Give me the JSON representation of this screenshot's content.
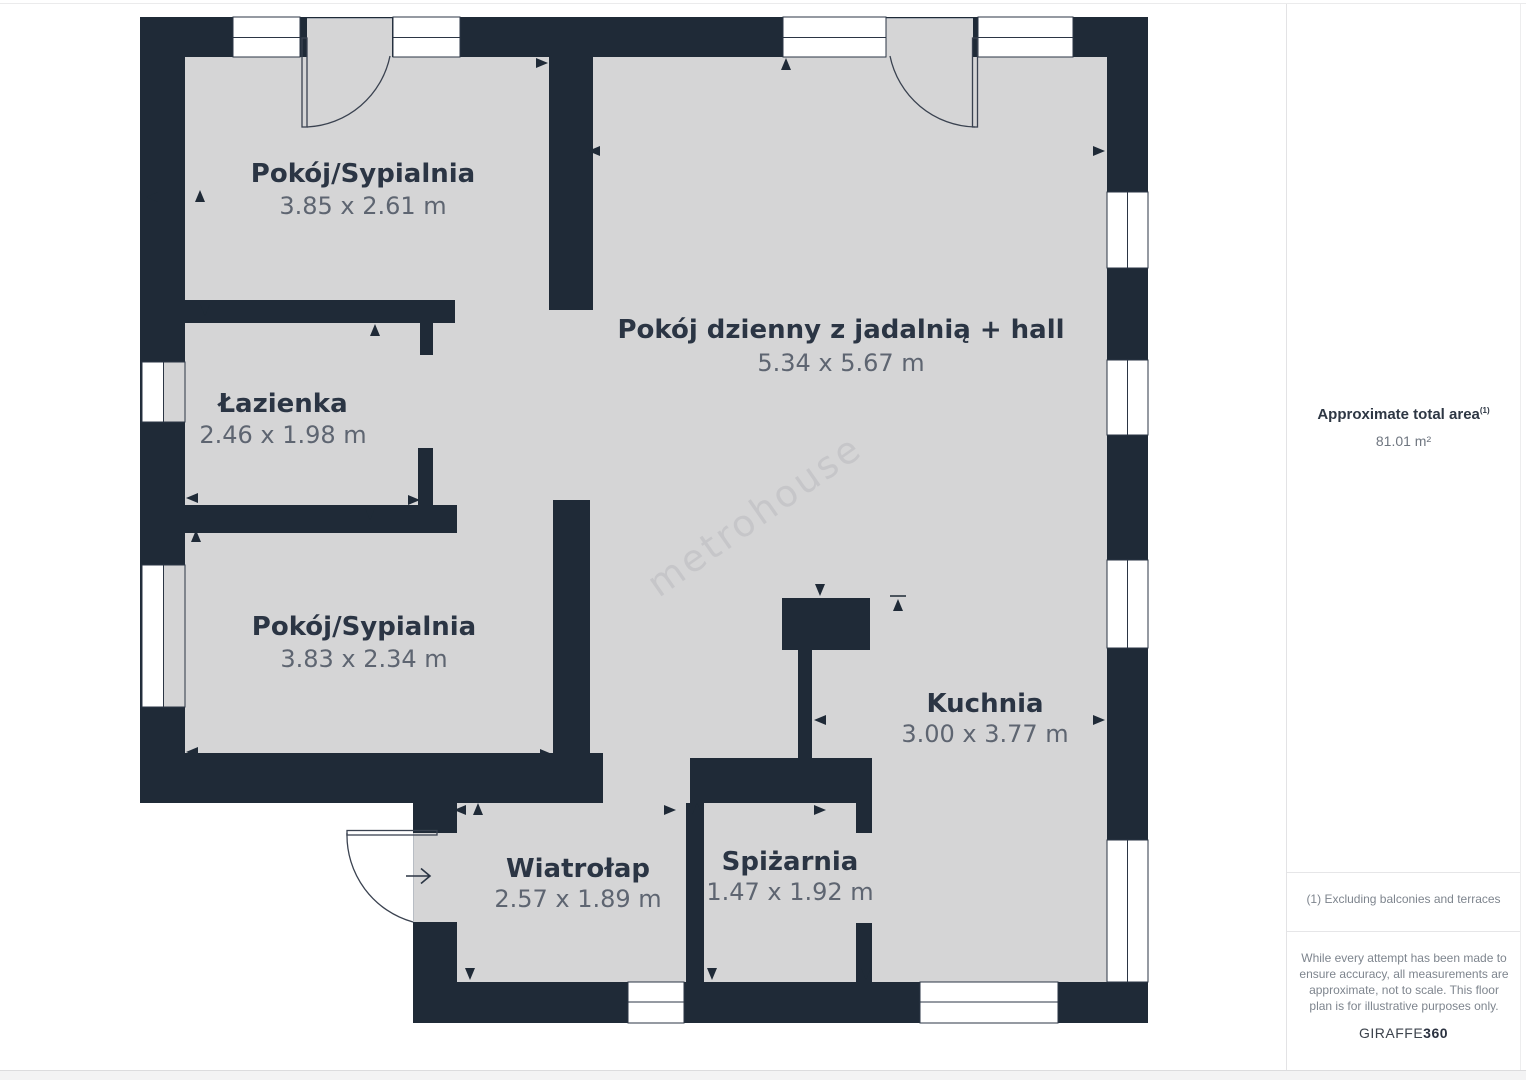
{
  "floor_plan": {
    "watermark": "metrohouse",
    "rooms": [
      {
        "name": "Pokój/Sypialnia",
        "dims": "3.85 x 2.61 m"
      },
      {
        "name": "Pokój dzienny z jadalnią + hall",
        "dims": "5.34 x 5.67 m"
      },
      {
        "name": "Łazienka",
        "dims": "2.46 x 1.98 m"
      },
      {
        "name": "Pokój/Sypialnia",
        "dims": "3.83 x 2.34 m"
      },
      {
        "name": "Kuchnia",
        "dims": "3.00 x 3.77 m"
      },
      {
        "name": "Wiatrołap",
        "dims": "2.57 x 1.89 m"
      },
      {
        "name": "Spiżarnia",
        "dims": "1.47 x 1.92 m"
      }
    ],
    "colors": {
      "wall": "#1f2a37",
      "floor": "#d5d5d6",
      "room_label": "#2b3544",
      "dims_label": "#5e6571"
    }
  },
  "sidebar": {
    "total_area_label": "Approximate total area",
    "total_area_superscript": "(1)",
    "total_area_value": "81.01 m²",
    "footnote": "(1) Excluding balconies and terraces",
    "disclaimer": "While every attempt has been made to ensure accuracy, all measurements are approximate, not to scale. This floor plan is for illustrative purposes only.",
    "brand": {
      "name": "GIRAFFE",
      "suffix": "360"
    }
  }
}
